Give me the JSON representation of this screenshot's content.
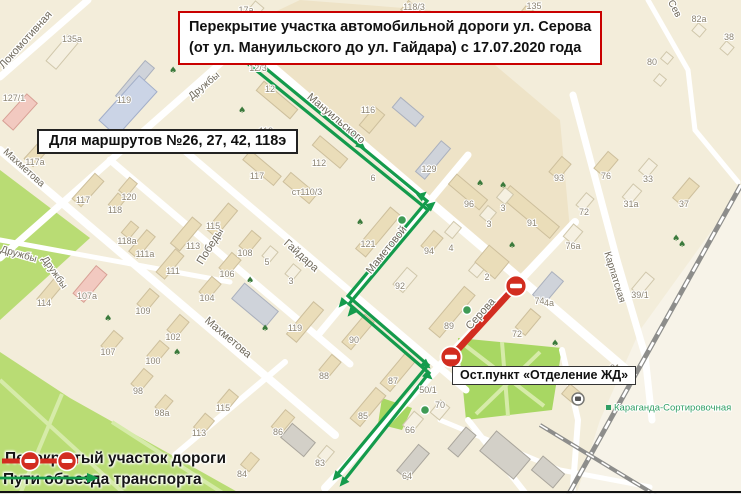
{
  "banner": {
    "line1": "Перекрытие участка автомобильной дороги ул. Серова",
    "line2": "(от ул. Мануильского до ул. Гайдара) с 17.07.2020 года"
  },
  "routes_note": {
    "text": "Для маршрутов №26, 27, 42, 118э"
  },
  "bus_stop_label": {
    "text": "Ост.пункт «Отделение ЖД»"
  },
  "legend": {
    "closed_label": "Перекрытый участок дороги",
    "detour_label": "Пути объезда транспорта"
  },
  "colors": {
    "bg": "#f3edda",
    "road": "#ffffff",
    "park": "#b9dc74",
    "park2": "#a8d763",
    "park_path": "#d6eba9",
    "rail": "#8d8d8b",
    "red": "#d22d20",
    "green": "#149b4c",
    "street_txt": "#6f695b",
    "house_txt": "#8c8472",
    "station_green": "#2f9e63",
    "tree": "#3b7a3c",
    "bld": {
      "be": [
        "#eaddb9",
        "#cdbf9c"
      ],
      "wh": [
        "#f5f0e1",
        "#d0c7ab"
      ],
      "bl": [
        "#cbd4e6",
        "#a2aec9"
      ],
      "pk": [
        "#f2c9c0",
        "#d8a095"
      ],
      "gr": [
        "#cfd3da",
        "#aab0bd"
      ],
      "dg": [
        "#d3d0c8",
        "#a9a59c"
      ]
    }
  },
  "map": {
    "tints": [
      {
        "p": "248,44 515,278 570,230 560,120 430,10 300,0 262,18",
        "c": "#eee3c7"
      },
      {
        "p": "741,190 640,330 600,420 575,499 741,499",
        "c": "#f7f3e8"
      }
    ],
    "parks": [
      {
        "p": "0,170 90,238 0,320",
        "c": "#b9dc74"
      },
      {
        "p": "0,352 70,398 250,499 0,499",
        "c": "#b9dc74"
      },
      {
        "p": "458,338 562,348 552,410 466,420",
        "c": "#a8d763"
      },
      {
        "p": "382,398 412,408 402,430 378,424",
        "c": "#a8d763"
      }
    ],
    "park_paths": [
      {
        "p": "0,380 130,499"
      },
      {
        "p": "62,394 18,499"
      },
      {
        "p": "112,422 232,499"
      },
      {
        "p": "466,346 544,406"
      },
      {
        "p": "540,352 476,414"
      },
      {
        "p": "502,342 508,416"
      }
    ],
    "roads": [
      {
        "p": "243,42 630,373",
        "w": 9
      },
      {
        "p": "110,160 350,364",
        "w": 7
      },
      {
        "p": "185,151 466,390",
        "w": 7
      },
      {
        "p": "0,150 335,435",
        "w": 8
      },
      {
        "p": "88,0 0,77",
        "w": 7
      },
      {
        "p": "258,30 0,258",
        "w": 7
      },
      {
        "p": "468,155 318,335",
        "w": 7
      },
      {
        "p": "575,222 325,488",
        "w": 8
      },
      {
        "p": "573,95 617,260 645,355 652,420",
        "w": 7
      },
      {
        "p": "285,362 175,455",
        "w": 6
      },
      {
        "p": "0,240 230,282",
        "w": 5
      },
      {
        "p": "648,0 688,70 695,130",
        "w": 5
      },
      {
        "p": "695,130 738,182",
        "w": 5
      },
      {
        "p": "468,420 530,499",
        "w": 6
      },
      {
        "p": "562,350 578,420 572,499",
        "w": 6
      },
      {
        "p": "440,420 560,470 650,487",
        "w": 5
      }
    ],
    "railways": [
      {
        "p": "741,185 566,499",
        "w": 5
      },
      {
        "p": "540,425 662,499",
        "w": 4
      }
    ],
    "buildings": [
      [
        62,
        52,
        34,
        13,
        -50,
        "wh"
      ],
      [
        135,
        82,
        46,
        12,
        -50,
        "gr"
      ],
      [
        20,
        112,
        36,
        14,
        -48,
        "pk"
      ],
      [
        128,
        106,
        60,
        24,
        -48,
        "bl"
      ],
      [
        40,
        150,
        34,
        12,
        -48,
        "be"
      ],
      [
        88,
        190,
        34,
        12,
        -48,
        "be"
      ],
      [
        250,
        16,
        30,
        11,
        -50,
        "wh"
      ],
      [
        277,
        100,
        44,
        12,
        40,
        "be"
      ],
      [
        262,
        168,
        40,
        12,
        40,
        "be"
      ],
      [
        300,
        188,
        34,
        12,
        40,
        "be"
      ],
      [
        330,
        152,
        36,
        12,
        40,
        "be"
      ],
      [
        372,
        120,
        13,
        24,
        40,
        "be"
      ],
      [
        408,
        112,
        30,
        13,
        40,
        "gr"
      ],
      [
        433,
        160,
        40,
        12,
        -50,
        "gr"
      ],
      [
        420,
        18,
        40,
        12,
        40,
        "be"
      ],
      [
        540,
        25,
        46,
        13,
        40,
        "be"
      ],
      [
        699,
        30,
        10,
        10,
        40,
        "wh"
      ],
      [
        727,
        48,
        10,
        10,
        40,
        "wh"
      ],
      [
        667,
        58,
        9,
        9,
        40,
        "wh"
      ],
      [
        660,
        80,
        9,
        9,
        40,
        "wh"
      ],
      [
        560,
        168,
        12,
        20,
        40,
        "be"
      ],
      [
        606,
        164,
        13,
        22,
        40,
        "be"
      ],
      [
        648,
        168,
        11,
        16,
        40,
        "wh"
      ],
      [
        632,
        194,
        11,
        17,
        40,
        "wh"
      ],
      [
        585,
        202,
        10,
        16,
        40,
        "wh"
      ],
      [
        573,
        234,
        12,
        16,
        40,
        "wh"
      ],
      [
        686,
        192,
        13,
        26,
        40,
        "be"
      ],
      [
        643,
        284,
        11,
        22,
        40,
        "wh"
      ],
      [
        530,
        212,
        64,
        15,
        40,
        "be"
      ],
      [
        468,
        192,
        40,
        13,
        40,
        "be"
      ],
      [
        505,
        196,
        11,
        13,
        40,
        "wh"
      ],
      [
        488,
        214,
        11,
        13,
        40,
        "wh"
      ],
      [
        378,
        232,
        54,
        13,
        -50,
        "be"
      ],
      [
        432,
        242,
        12,
        20,
        40,
        "be"
      ],
      [
        453,
        230,
        10,
        14,
        40,
        "wh"
      ],
      [
        405,
        280,
        13,
        22,
        40,
        "wh"
      ],
      [
        452,
        312,
        55,
        14,
        -50,
        "be"
      ],
      [
        478,
        268,
        11,
        16,
        40,
        "wh"
      ],
      [
        548,
        288,
        15,
        30,
        40,
        "gr"
      ],
      [
        528,
        322,
        13,
        24,
        40,
        "be"
      ],
      [
        492,
        262,
        26,
        22,
        40,
        "be"
      ],
      [
        222,
        220,
        34,
        12,
        -50,
        "be"
      ],
      [
        186,
        234,
        34,
        12,
        -50,
        "be"
      ],
      [
        142,
        244,
        28,
        11,
        -50,
        "be"
      ],
      [
        170,
        264,
        30,
        11,
        -50,
        "be"
      ],
      [
        128,
        187,
        10,
        17,
        40,
        "be"
      ],
      [
        117,
        202,
        10,
        15,
        40,
        "be"
      ],
      [
        130,
        230,
        10,
        15,
        40,
        "be"
      ],
      [
        250,
        242,
        12,
        20,
        40,
        "be"
      ],
      [
        230,
        264,
        12,
        20,
        40,
        "be"
      ],
      [
        210,
        288,
        12,
        20,
        40,
        "be"
      ],
      [
        255,
        305,
        44,
        20,
        40,
        "gr"
      ],
      [
        270,
        254,
        10,
        13,
        40,
        "wh"
      ],
      [
        293,
        272,
        10,
        13,
        40,
        "wh"
      ],
      [
        305,
        322,
        42,
        13,
        -50,
        "be"
      ],
      [
        90,
        284,
        36,
        14,
        -50,
        "pk"
      ],
      [
        50,
        292,
        28,
        11,
        -50,
        "be"
      ],
      [
        148,
        300,
        12,
        20,
        40,
        "be"
      ],
      [
        112,
        342,
        12,
        20,
        40,
        "be"
      ],
      [
        178,
        326,
        12,
        20,
        40,
        "be"
      ],
      [
        158,
        352,
        12,
        20,
        40,
        "be"
      ],
      [
        142,
        380,
        12,
        20,
        40,
        "be"
      ],
      [
        164,
        404,
        10,
        16,
        40,
        "be"
      ],
      [
        358,
        332,
        36,
        12,
        -50,
        "be"
      ],
      [
        398,
        372,
        40,
        13,
        -50,
        "be"
      ],
      [
        368,
        407,
        40,
        13,
        -50,
        "be"
      ],
      [
        413,
        422,
        12,
        18,
        40,
        "wh"
      ],
      [
        413,
        462,
        34,
        14,
        -50,
        "dg"
      ],
      [
        440,
        410,
        12,
        16,
        40,
        "wh"
      ],
      [
        283,
        422,
        12,
        22,
        40,
        "be"
      ],
      [
        330,
        366,
        12,
        20,
        40,
        "be"
      ],
      [
        228,
        400,
        12,
        18,
        40,
        "be"
      ],
      [
        204,
        424,
        12,
        18,
        40,
        "be"
      ],
      [
        326,
        454,
        10,
        14,
        40,
        "wh"
      ],
      [
        250,
        462,
        11,
        16,
        40,
        "be"
      ],
      [
        298,
        440,
        30,
        18,
        40,
        "dg"
      ],
      [
        505,
        455,
        44,
        26,
        40,
        "dg"
      ],
      [
        548,
        472,
        28,
        18,
        40,
        "dg"
      ],
      [
        462,
        442,
        13,
        28,
        40,
        "dg"
      ],
      [
        572,
        394,
        16,
        13,
        40,
        "be"
      ]
    ],
    "street_labels": [
      {
        "t": "Локомотивная",
        "x": 28,
        "y": 42,
        "r": -48,
        "s": 11
      },
      {
        "t": "Дружбы",
        "x": 206,
        "y": 88,
        "r": -40,
        "s": 10
      },
      {
        "t": "Мануильского",
        "x": 334,
        "y": 121,
        "r": 40,
        "s": 11
      },
      {
        "t": "Махметова",
        "x": 22,
        "y": 170,
        "r": 42,
        "s": 10
      },
      {
        "t": "Махметова",
        "x": 226,
        "y": 340,
        "r": 40,
        "s": 11
      },
      {
        "t": "Дружбы",
        "x": 18,
        "y": 257,
        "r": 16,
        "s": 10
      },
      {
        "t": "Дружбы",
        "x": 52,
        "y": 274,
        "r": 55,
        "s": 10
      },
      {
        "t": "Победы",
        "x": 213,
        "y": 248,
        "r": -58,
        "s": 11
      },
      {
        "t": "Гайдара",
        "x": 299,
        "y": 258,
        "r": 42,
        "s": 11
      },
      {
        "t": "Маметовой",
        "x": 389,
        "y": 252,
        "r": -51,
        "s": 11
      },
      {
        "t": "Серова",
        "x": 483,
        "y": 316,
        "r": -48,
        "s": 11
      },
      {
        "t": "Карпатская",
        "x": 612,
        "y": 278,
        "r": 73,
        "s": 10
      },
      {
        "t": "Сев",
        "x": 672,
        "y": 10,
        "r": 62,
        "s": 10
      }
    ],
    "house_labels": [
      [
        "17а",
        246,
        10
      ],
      [
        "118/3",
        414,
        7
      ],
      [
        "135",
        534,
        6
      ],
      [
        "135а",
        72,
        39
      ],
      [
        "127/1",
        14,
        98
      ],
      [
        "119",
        124,
        100
      ],
      [
        "12/3",
        258,
        68
      ],
      [
        "12",
        270,
        89
      ],
      [
        "119",
        266,
        131
      ],
      [
        "117",
        257,
        176
      ],
      [
        "112",
        319,
        163
      ],
      [
        "ст110/3",
        307,
        192
      ],
      [
        "116",
        368,
        110
      ],
      [
        "6",
        373,
        178
      ],
      [
        "129",
        429,
        169
      ],
      [
        "117а",
        35,
        162
      ],
      [
        "117",
        83,
        200
      ],
      [
        "120",
        129,
        197
      ],
      [
        "118",
        115,
        210
      ],
      [
        "118а",
        127,
        241
      ],
      [
        "107а",
        87,
        296
      ],
      [
        "114",
        44,
        303
      ],
      [
        "109",
        143,
        311
      ],
      [
        "107",
        108,
        352
      ],
      [
        "102",
        173,
        337
      ],
      [
        "100",
        153,
        361
      ],
      [
        "98",
        138,
        391
      ],
      [
        "98а",
        162,
        413
      ],
      [
        "115",
        213,
        226
      ],
      [
        "113",
        193,
        246
      ],
      [
        "111а",
        145,
        254
      ],
      [
        "111",
        173,
        271
      ],
      [
        "108",
        245,
        253
      ],
      [
        "106",
        227,
        274
      ],
      [
        "104",
        207,
        298
      ],
      [
        "5",
        267,
        262
      ],
      [
        "3",
        291,
        281
      ],
      [
        "119",
        295,
        328
      ],
      [
        "90",
        354,
        340
      ],
      [
        "121",
        368,
        244
      ],
      [
        "94",
        429,
        251
      ],
      [
        "92",
        400,
        286
      ],
      [
        "89",
        449,
        326
      ],
      [
        "4",
        451,
        248
      ],
      [
        "96",
        469,
        204
      ],
      [
        "3",
        503,
        208
      ],
      [
        "3",
        489,
        224
      ],
      [
        "91",
        532,
        223
      ],
      [
        "93",
        559,
        178
      ],
      [
        "2",
        487,
        277
      ],
      [
        "74а",
        542,
        301
      ],
      [
        "72",
        517,
        334
      ],
      [
        "76",
        606,
        176
      ],
      [
        "33",
        648,
        179
      ],
      [
        "31а",
        631,
        204
      ],
      [
        "72",
        584,
        212
      ],
      [
        "76а",
        573,
        246
      ],
      [
        "37",
        684,
        204
      ],
      [
        "39/1",
        640,
        295
      ],
      [
        "4а",
        549,
        303
      ],
      [
        "82а",
        699,
        19
      ],
      [
        "38",
        729,
        37
      ],
      [
        "80",
        652,
        62
      ],
      [
        "88",
        324,
        376
      ],
      [
        "86",
        278,
        432
      ],
      [
        "83",
        320,
        463
      ],
      [
        "84",
        242,
        474
      ],
      [
        "115",
        223,
        408
      ],
      [
        "113",
        199,
        433
      ],
      [
        "87",
        393,
        381
      ],
      [
        "85",
        363,
        416
      ],
      [
        "66",
        410,
        430
      ],
      [
        "64",
        407,
        476
      ],
      [
        "70",
        440,
        405
      ],
      [
        "50/1",
        428,
        390
      ],
      [
        "31",
        615,
        368
      ]
    ],
    "trees": [
      [
        37,
        26
      ],
      [
        173,
        70
      ],
      [
        242,
        110
      ],
      [
        360,
        222
      ],
      [
        250,
        280
      ],
      [
        265,
        328
      ],
      [
        480,
        183
      ],
      [
        503,
        185
      ],
      [
        512,
        245
      ],
      [
        108,
        318
      ],
      [
        177,
        352
      ],
      [
        555,
        343
      ],
      [
        676,
        238
      ],
      [
        682,
        244
      ]
    ],
    "pois": [
      [
        402,
        220
      ],
      [
        467,
        310
      ],
      [
        425,
        410
      ]
    ],
    "route": {
      "line1": "241,48 427,201 348,296 428,365 336,476",
      "line2": "236,54 428,210 349,304 429,373 343,482",
      "arrows": [
        {
          "x": 351,
          "y": 133,
          "a": 40
        },
        {
          "x": 358,
          "y": 143,
          "a": 40
        },
        {
          "x": 419,
          "y": 198,
          "a": -40
        },
        {
          "x": 428,
          "y": 208,
          "a": -40
        },
        {
          "x": 345,
          "y": 300,
          "a": 130
        },
        {
          "x": 354,
          "y": 309,
          "a": 130
        },
        {
          "x": 423,
          "y": 362,
          "a": 41
        },
        {
          "x": 425,
          "y": 373,
          "a": 41
        },
        {
          "x": 339,
          "y": 473,
          "a": 130
        },
        {
          "x": 346,
          "y": 479,
          "a": 130
        }
      ]
    },
    "closed": {
      "x1": 516,
      "y1": 286,
      "x2": 451,
      "y2": 357,
      "signs": [
        [
          516,
          286
        ],
        [
          451,
          357
        ]
      ]
    },
    "station": {
      "label": "Караганда-Сортировочная",
      "x": 614,
      "y": 414,
      "icon_x": 578,
      "icon_y": 399
    }
  }
}
